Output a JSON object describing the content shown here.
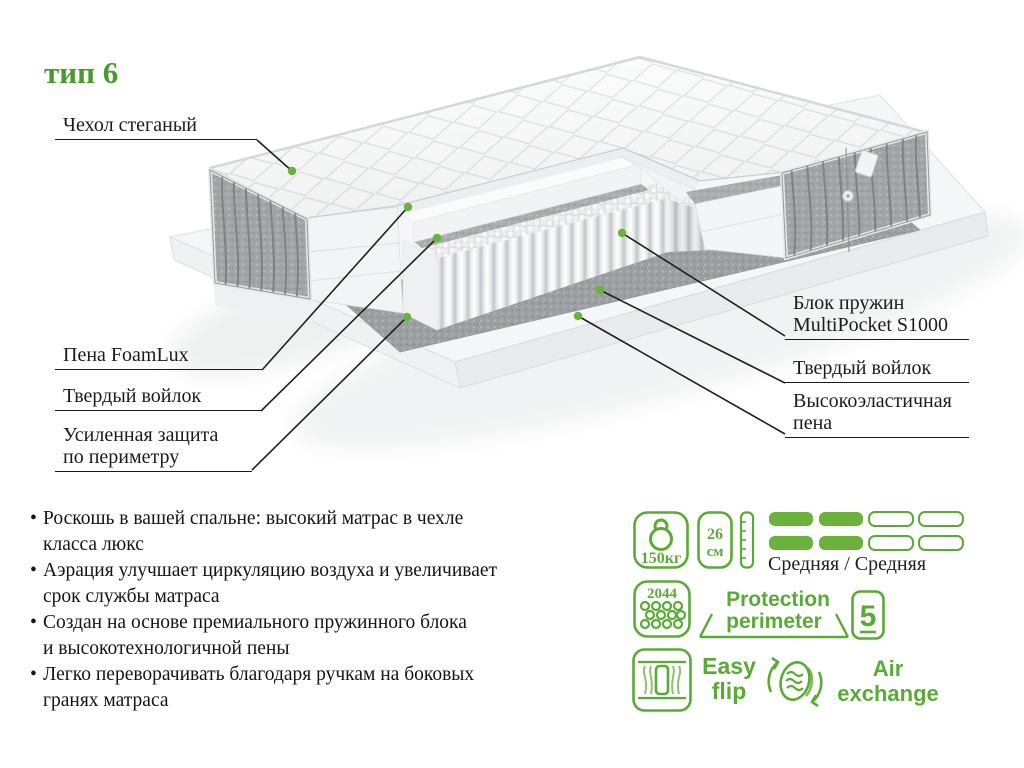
{
  "title": {
    "text": "тип 6",
    "color": "#4a9b2f"
  },
  "callouts": {
    "left": [
      {
        "lines": [
          "Чехол стеганый"
        ]
      },
      {
        "lines": [
          "Пена FoamLux"
        ]
      },
      {
        "lines": [
          "Твердый войлок"
        ]
      },
      {
        "lines": [
          "Усиленная защита",
          "по периметру"
        ]
      }
    ],
    "right": [
      {
        "lines": [
          "Блок пружин",
          "MultiPocket S1000"
        ]
      },
      {
        "lines": [
          "Твердый войлок"
        ]
      },
      {
        "lines": [
          "Высокоэластичная",
          "пена"
        ]
      }
    ]
  },
  "features": {
    "bullet_char": "•",
    "items": [
      {
        "lines": [
          "Роскошь в вашей спальне: высокий матрас в чехле",
          "класса люкс"
        ]
      },
      {
        "lines": [
          "Аэрация улучшает циркуляцию воздуха и увеличивает",
          "срок службы матраса"
        ]
      },
      {
        "lines": [
          "Создан на основе премиального пружинного блока",
          "и высокотехнологичной пены"
        ]
      },
      {
        "lines": [
          "Легко переворачивать благодаря ручкам на боковых",
          "гранях матраса"
        ]
      }
    ]
  },
  "specs": {
    "max_weight": "150кг",
    "height_value": "26",
    "height_unit": "см",
    "springs_count": "2044",
    "firmness_label": "Средняя / Средняя",
    "firmness_filled": 2,
    "firmness_total": 4,
    "protection_line1": "Protection",
    "protection_line2": "perimeter",
    "zones": "5",
    "easy_flip": [
      "Easy",
      "flip"
    ],
    "air_exchange": [
      "Air",
      "exchange"
    ],
    "accent_color": "#5aab35",
    "bar_fill_color": "#6ab23c",
    "dot_color": "#69b33a"
  }
}
